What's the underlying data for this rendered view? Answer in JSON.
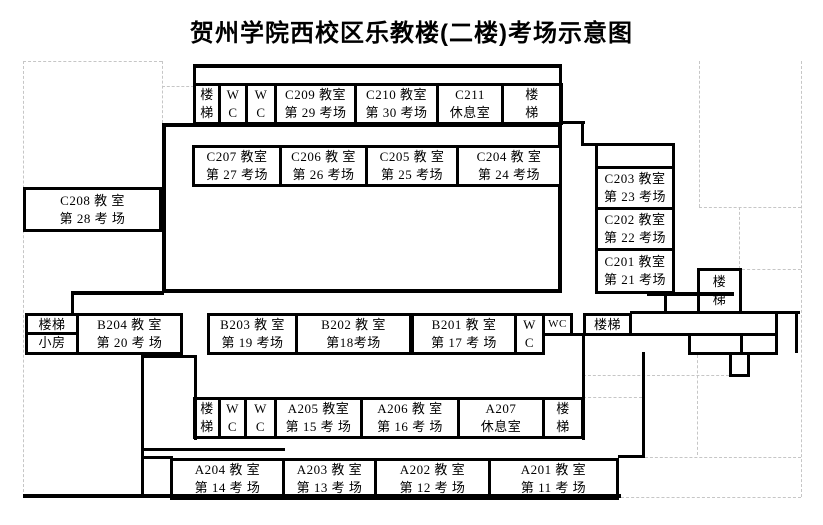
{
  "title": "贺州学院西校区乐教楼(二楼)考场示意图",
  "rooms": [
    {
      "id": "stair-tl",
      "kind": "stairs",
      "lines": [
        "楼",
        "梯"
      ]
    },
    {
      "id": "wc-t1",
      "kind": "wc",
      "lines": [
        "W",
        "C"
      ]
    },
    {
      "id": "wc-t2",
      "kind": "wc",
      "lines": [
        "W",
        "C"
      ]
    },
    {
      "id": "C209",
      "kind": "exam-room",
      "lines": [
        "C209 教室",
        "第 29 考场"
      ]
    },
    {
      "id": "C210",
      "kind": "exam-room",
      "lines": [
        "C210 教室",
        "第 30 考场"
      ]
    },
    {
      "id": "C211",
      "kind": "rest-room",
      "lines": [
        "C211",
        "休息室"
      ]
    },
    {
      "id": "stair-tr",
      "kind": "stairs",
      "lines": [
        "楼",
        "梯"
      ]
    },
    {
      "id": "C207",
      "kind": "exam-room",
      "lines": [
        "C207 教室",
        "第 27 考场"
      ]
    },
    {
      "id": "C206",
      "kind": "exam-room",
      "lines": [
        "C206 教 室",
        "第 26 考场"
      ]
    },
    {
      "id": "C205",
      "kind": "exam-room",
      "lines": [
        "C205 教 室",
        "第 25 考场"
      ]
    },
    {
      "id": "C204",
      "kind": "exam-room",
      "lines": [
        "C204 教 室",
        "第 24 考场"
      ]
    },
    {
      "id": "C208",
      "kind": "exam-room",
      "lines": [
        "C208 教 室",
        "第 28 考 场"
      ]
    },
    {
      "id": "C203",
      "kind": "exam-room",
      "lines": [
        "C203 教室",
        "第 23 考场"
      ]
    },
    {
      "id": "C202",
      "kind": "exam-room",
      "lines": [
        "C202 教室",
        "第 22 考场"
      ]
    },
    {
      "id": "C201",
      "kind": "exam-room",
      "lines": [
        "C201 教室",
        "第 21 考场"
      ]
    },
    {
      "id": "stair-sm",
      "kind": "stairs-small-room",
      "lines": [
        "楼梯",
        "小房"
      ]
    },
    {
      "id": "B204",
      "kind": "exam-room",
      "lines": [
        "B204 教 室",
        "第 20 考 场"
      ]
    },
    {
      "id": "B203",
      "kind": "exam-room",
      "lines": [
        "B203 教 室",
        "第 19 考场"
      ]
    },
    {
      "id": "B202",
      "kind": "exam-room",
      "lines": [
        "B202 教 室",
        "第18考场"
      ]
    },
    {
      "id": "B201",
      "kind": "exam-room",
      "lines": [
        "B201 教 室",
        "第 17 考 场"
      ]
    },
    {
      "id": "wc-b1",
      "kind": "wc",
      "lines": [
        "W",
        "C"
      ]
    },
    {
      "id": "wc-b2",
      "kind": "wc",
      "lines": [
        "WC"
      ]
    },
    {
      "id": "stair-b1",
      "kind": "stairs",
      "lines": [
        "楼梯"
      ]
    },
    {
      "id": "stair-mid",
      "kind": "stairs",
      "lines": [
        "楼",
        "梯"
      ]
    },
    {
      "id": "stair-al",
      "kind": "stairs",
      "lines": [
        "楼",
        "梯"
      ]
    },
    {
      "id": "wc-a1",
      "kind": "wc",
      "lines": [
        "W",
        "C"
      ]
    },
    {
      "id": "wc-a2",
      "kind": "wc",
      "lines": [
        "W",
        "C"
      ]
    },
    {
      "id": "A205",
      "kind": "exam-room",
      "lines": [
        "A205 教室",
        "第 15 考 场"
      ]
    },
    {
      "id": "A206",
      "kind": "exam-room",
      "lines": [
        "A206 教 室",
        "第 16 考 场"
      ]
    },
    {
      "id": "A207",
      "kind": "rest-room",
      "lines": [
        "A207",
        "休息室"
      ]
    },
    {
      "id": "stair-ar",
      "kind": "stairs",
      "lines": [
        "楼",
        "梯"
      ]
    },
    {
      "id": "A204",
      "kind": "exam-room",
      "lines": [
        "A204 教 室",
        "第 14 考 场"
      ]
    },
    {
      "id": "A203",
      "kind": "exam-room",
      "lines": [
        "A203 教 室",
        "第 13 考 场"
      ]
    },
    {
      "id": "A202",
      "kind": "exam-room",
      "lines": [
        "A202 教 室",
        "第 12 考 场"
      ]
    },
    {
      "id": "A201",
      "kind": "exam-room",
      "lines": [
        "A201 教 室",
        "第 11 考 场"
      ]
    }
  ],
  "colors": {
    "wall": "#000000",
    "grid": "#c6c6c6",
    "background": "#ffffff"
  }
}
